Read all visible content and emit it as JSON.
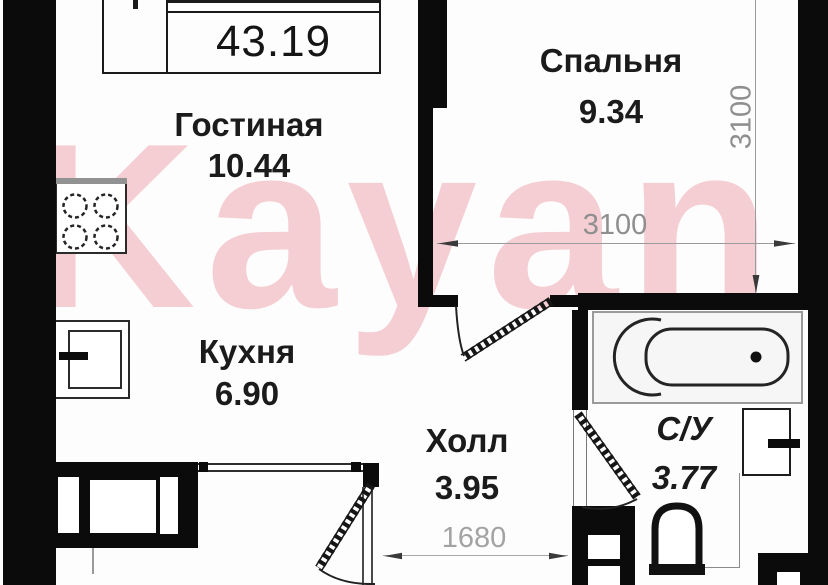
{
  "plan": {
    "title": "Floor plan of 1-bedroom apartment",
    "total_area": "43.19",
    "watermark": {
      "text": "Kayan",
      "color": "#de5264"
    },
    "rooms": [
      {
        "name": "Гостиная",
        "area": "10.44"
      },
      {
        "name": "Спальня",
        "area": "9.34"
      },
      {
        "name": "Кухня",
        "area": "6.90"
      },
      {
        "name": "Холл",
        "area": "3.95"
      },
      {
        "name": "С/У",
        "area": "3.77"
      }
    ],
    "dimensions": {
      "bedroom_width": "3100",
      "bedroom_height": "3100",
      "hall_width": "1680"
    },
    "fixtures": [
      "stove-icon",
      "kitchen-sink-icon",
      "bathtub-icon",
      "washbasin-icon",
      "toilet-icon"
    ],
    "colors": {
      "wall": "#0b0b0b",
      "dimension": "#8f8f8f",
      "background": "#fdfdfd"
    }
  }
}
